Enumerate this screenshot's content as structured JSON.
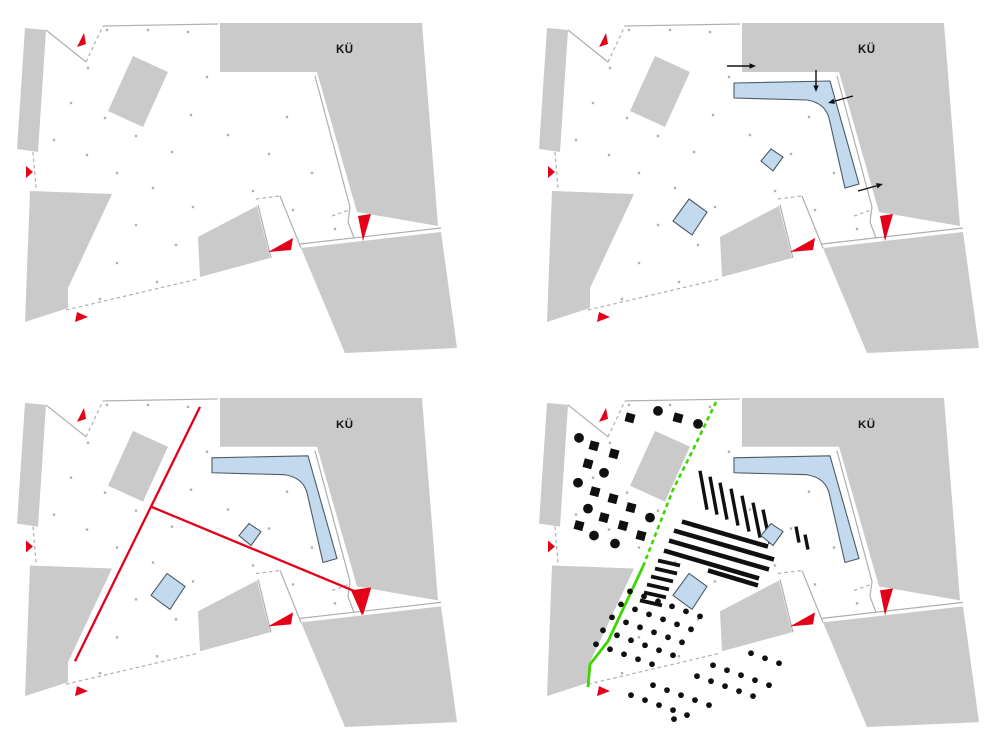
{
  "colors": {
    "page_bg": "#ffffff",
    "building": "#cacaca",
    "boundary": "#afafaf",
    "plaza_dot": "#b2b2b2",
    "red": "#e50019",
    "blue_fill": "#c3d9ed",
    "blue_stroke": "#4d5a64",
    "black": "#101010",
    "green": "#3ed500"
  },
  "base": {
    "label_pos": [
      336,
      53
    ],
    "buildings": [
      {
        "name": "strip-west",
        "points": [
          [
            25,
            28
          ],
          [
            46,
            30
          ],
          [
            38,
            152
          ],
          [
            17,
            149
          ]
        ]
      },
      {
        "name": "block-northwest",
        "points": [
          [
            133,
            56
          ],
          [
            168,
            72
          ],
          [
            143,
            127
          ],
          [
            108,
            111
          ]
        ]
      },
      {
        "name": "block-ku",
        "points": [
          [
            220,
            23
          ],
          [
            422,
            23
          ],
          [
            438,
            226
          ],
          [
            357,
            212
          ],
          [
            317,
            72
          ],
          [
            220,
            72
          ]
        ]
      },
      {
        "name": "block-southeast",
        "points": [
          [
            301,
            248
          ],
          [
            441,
            232
          ],
          [
            457,
            348
          ],
          [
            345,
            353
          ]
        ]
      },
      {
        "name": "wedge-southwest",
        "points": [
          [
            30,
            191
          ],
          [
            112,
            194
          ],
          [
            68,
            288
          ],
          [
            68,
            308
          ],
          [
            25,
            322
          ]
        ]
      },
      {
        "name": "block-south",
        "points": [
          [
            198,
            237
          ],
          [
            257,
            206
          ],
          [
            270,
            258
          ],
          [
            200,
            277
          ]
        ]
      }
    ],
    "boundaries": [
      {
        "points": [
          [
            46,
            30
          ],
          [
            86,
            62
          ]
        ],
        "dashed": false
      },
      {
        "points": [
          [
            86,
            62
          ],
          [
            103,
            26
          ]
        ],
        "dashed": true
      },
      {
        "points": [
          [
            103,
            26
          ],
          [
            218,
            24
          ]
        ],
        "dashed": false
      },
      {
        "points": [
          [
            315,
            76
          ],
          [
            350,
            207
          ],
          [
            348,
            222
          ],
          [
            354,
            238
          ]
        ],
        "dashed": false
      },
      {
        "points": [
          [
            332,
            216
          ],
          [
            349,
            210
          ]
        ],
        "dashed": true
      },
      {
        "points": [
          [
            300,
            244
          ],
          [
            441,
            228
          ]
        ],
        "dashed": false
      },
      {
        "points": [
          [
            258,
            205
          ],
          [
            271,
            258
          ]
        ],
        "dashed": false
      },
      {
        "points": [
          [
            256,
            199
          ],
          [
            280,
            196
          ]
        ],
        "dashed": true
      },
      {
        "points": [
          [
            280,
            196
          ],
          [
            301,
            248
          ]
        ],
        "dashed": false
      },
      {
        "points": [
          [
            33,
            152
          ],
          [
            36,
            188
          ]
        ],
        "dashed": true
      },
      {
        "points": [
          [
            66,
            310
          ],
          [
            198,
            279
          ]
        ],
        "dashed": true
      }
    ],
    "dots": [
      [
        107,
        30
      ],
      [
        148,
        30
      ],
      [
        188,
        32
      ],
      [
        88,
        68
      ],
      [
        207,
        77
      ],
      [
        71,
        103
      ],
      [
        105,
        118
      ],
      [
        191,
        115
      ],
      [
        287,
        117
      ],
      [
        228,
        135
      ],
      [
        54,
        140
      ],
      [
        136,
        136
      ],
      [
        172,
        152
      ],
      [
        87,
        155
      ],
      [
        269,
        154
      ],
      [
        312,
        173
      ],
      [
        117,
        173
      ],
      [
        153,
        188
      ],
      [
        253,
        191
      ],
      [
        193,
        207
      ],
      [
        293,
        210
      ],
      [
        136,
        225
      ],
      [
        176,
        245
      ],
      [
        335,
        229
      ],
      [
        117,
        263
      ],
      [
        157,
        282
      ],
      [
        100,
        299
      ]
    ],
    "red_arrows": [
      {
        "name": "entrance-arrow-north",
        "points": [
          [
            84,
            33
          ],
          [
            77,
            47
          ],
          [
            86,
            44
          ]
        ]
      },
      {
        "name": "entrance-arrow-west",
        "points": [
          [
            26,
            166
          ],
          [
            33,
            172
          ],
          [
            26,
            178
          ]
        ]
      },
      {
        "name": "entrance-arrow-south-center",
        "points": [
          [
            268,
            252
          ],
          [
            293,
            238
          ],
          [
            291,
            250
          ]
        ]
      },
      {
        "name": "entrance-arrow-east",
        "points": [
          [
            358,
            216
          ],
          [
            371,
            214
          ],
          [
            363,
            241
          ]
        ]
      },
      {
        "name": "entrance-arrow-southwest",
        "points": [
          [
            75,
            322
          ],
          [
            88,
            317
          ],
          [
            77,
            312
          ]
        ]
      }
    ]
  },
  "blue": {
    "l_building_path": "M212,83 L308,81 L337,184 L323,188 L307,118 Q303,103 285,100 L212,98 Z",
    "pavilion_small": [
      [
        249,
        149
      ],
      [
        261,
        157
      ],
      [
        251,
        171
      ],
      [
        239,
        161
      ]
    ],
    "pavilion_large": [
      [
        167,
        199
      ],
      [
        185,
        212
      ],
      [
        170,
        235
      ],
      [
        151,
        221
      ]
    ]
  },
  "panels": [
    {
      "label": "KÜ",
      "name": "existing-site",
      "offset": [
        0,
        0
      ],
      "show_blue": false
    },
    {
      "label": "KÜ",
      "name": "access-concept",
      "offset": [
        22,
        0
      ],
      "show_blue": true,
      "black_arrows": [
        {
          "from": [
            205,
            66
          ],
          "to": [
            234,
            66
          ]
        },
        {
          "from": [
            294,
            70
          ],
          "to": [
            294,
            92
          ]
        },
        {
          "from": [
            331,
            96
          ],
          "to": [
            306,
            103
          ]
        },
        {
          "from": [
            336,
            191
          ],
          "to": [
            361,
            184
          ]
        }
      ]
    },
    {
      "label": "KÜ",
      "name": "axes-concept",
      "offset": [
        0,
        0
      ],
      "show_blue": true,
      "red_lines": [
        {
          "from": [
            200,
            32
          ],
          "to": [
            75,
            287
          ]
        },
        {
          "from": [
            151,
            132
          ],
          "to": [
            360,
            219
          ]
        }
      ],
      "red_arrowhead": [
        [
          351,
          216
        ],
        [
          371,
          213
        ],
        [
          362,
          241
        ]
      ]
    },
    {
      "label": "KÜ",
      "name": "landscape-concept",
      "offset": [
        22,
        0
      ],
      "show_blue": true,
      "green_dashed": [
        [
          194,
          27
        ],
        [
          171,
          75
        ],
        [
          151,
          115
        ],
        [
          121,
          192
        ]
      ],
      "green_solid": [
        [
          121,
          192
        ],
        [
          86,
          267
        ],
        [
          68,
          290
        ],
        [
          66,
          313
        ]
      ],
      "tree_circles": [
        [
          57,
          63
        ],
        [
          82,
          98
        ],
        [
          56,
          108
        ],
        [
          66,
          134
        ],
        [
          128,
          143
        ],
        [
          72,
          161
        ],
        [
          93,
          169
        ],
        [
          136,
          36
        ],
        [
          176,
          49
        ]
      ],
      "tree_squares": [
        [
          72,
          71
        ],
        [
          92,
          79
        ],
        [
          66,
          89
        ],
        [
          73,
          117
        ],
        [
          91,
          124
        ],
        [
          109,
          133
        ],
        [
          82,
          143
        ],
        [
          101,
          151
        ],
        [
          57,
          151
        ],
        [
          119,
          161
        ],
        [
          108,
          43
        ],
        [
          156,
          43
        ]
      ],
      "bars": [
        [
          178,
          96,
          185,
          135
        ],
        [
          188,
          102,
          195,
          140
        ],
        [
          198,
          108,
          205,
          145
        ],
        [
          209,
          114,
          216,
          151
        ],
        [
          220,
          121,
          227,
          157
        ],
        [
          231,
          128,
          238,
          163
        ],
        [
          241,
          135,
          248,
          169
        ],
        [
          274,
          152,
          277,
          168
        ],
        [
          283,
          160,
          286,
          175
        ]
      ],
      "stripes": [
        [
          160,
          147,
          246,
          172
        ],
        [
          152,
          156,
          252,
          185
        ],
        [
          147,
          166,
          247,
          195
        ],
        [
          142,
          176,
          237,
          204
        ],
        [
          186,
          196,
          236,
          211
        ]
      ],
      "ladder": [
        [
          136,
          186,
          158,
          191
        ],
        [
          133,
          194,
          155,
          199
        ],
        [
          129,
          202,
          151,
          207
        ],
        [
          125,
          210,
          147,
          215
        ],
        [
          122,
          218,
          144,
          223
        ],
        [
          118,
          226,
          140,
          231
        ]
      ],
      "dots_upper": [
        [
          108,
          217
        ],
        [
          122,
          222
        ],
        [
          136,
          227
        ],
        [
          150,
          232
        ],
        [
          164,
          237
        ],
        [
          178,
          242
        ],
        [
          99,
          230
        ],
        [
          113,
          235
        ],
        [
          127,
          240
        ],
        [
          141,
          245
        ],
        [
          155,
          250
        ],
        [
          169,
          255
        ],
        [
          90,
          243
        ],
        [
          104,
          248
        ],
        [
          118,
          253
        ],
        [
          132,
          258
        ],
        [
          146,
          263
        ],
        [
          160,
          268
        ],
        [
          81,
          256
        ],
        [
          95,
          261
        ],
        [
          109,
          266
        ],
        [
          123,
          271
        ],
        [
          137,
          276
        ],
        [
          151,
          281
        ],
        [
          74,
          270
        ],
        [
          88,
          275
        ],
        [
          102,
          280
        ],
        [
          116,
          285
        ],
        [
          130,
          290
        ]
      ],
      "dots_lower": [
        [
          191,
          291
        ],
        [
          205,
          296
        ],
        [
          219,
          301
        ],
        [
          233,
          306
        ],
        [
          247,
          311
        ],
        [
          175,
          302
        ],
        [
          189,
          307
        ],
        [
          203,
          312
        ],
        [
          217,
          317
        ],
        [
          231,
          322
        ],
        [
          131,
          311
        ],
        [
          145,
          316
        ],
        [
          159,
          321
        ],
        [
          173,
          326
        ],
        [
          187,
          331
        ],
        [
          109,
          321
        ],
        [
          123,
          326
        ],
        [
          137,
          331
        ],
        [
          151,
          336
        ],
        [
          165,
          341
        ],
        [
          229,
          279
        ],
        [
          243,
          284
        ],
        [
          257,
          289
        ],
        [
          152,
          345
        ]
      ]
    }
  ]
}
